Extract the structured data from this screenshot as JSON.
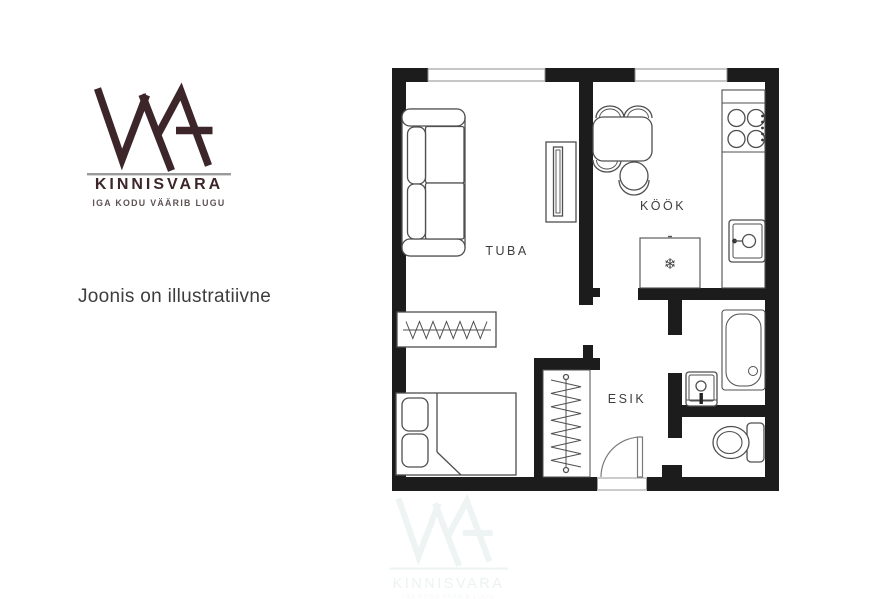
{
  "branding": {
    "monogram": "WA",
    "company": "KINNISVARA",
    "tagline": "IGA KODU VÄÄRIB LUGU",
    "logo_color": "#3c262a",
    "tagline_color": "#5e5254"
  },
  "note": "Joonis on illustratiivne",
  "floorplan": {
    "rooms": [
      {
        "id": "tuba",
        "label": "TUBA"
      },
      {
        "id": "kook",
        "label": "KÖÖK"
      },
      {
        "id": "esik",
        "label": "ESIK"
      }
    ],
    "symbols": {
      "fridge_snowflake": "❄"
    },
    "furniture": [
      "sofa",
      "tv-stand",
      "dining-table",
      "dining-chairs",
      "stool",
      "fridge",
      "kitchen-counter",
      "stove",
      "kitchen-sink",
      "bathtub",
      "bathroom-sink",
      "toilet",
      "wardrobe",
      "closet-rail",
      "bed",
      "entrance-door",
      "windows"
    ],
    "colors": {
      "wall": "#1c1c1c",
      "furniture_outline": "#4f4f4f",
      "label_text": "#3e3e3e"
    }
  },
  "watermark": {
    "company": "KINNISVARA",
    "tagline": "IGA KODU VÄÄRIB LUGU",
    "color": "#eef4f3"
  }
}
